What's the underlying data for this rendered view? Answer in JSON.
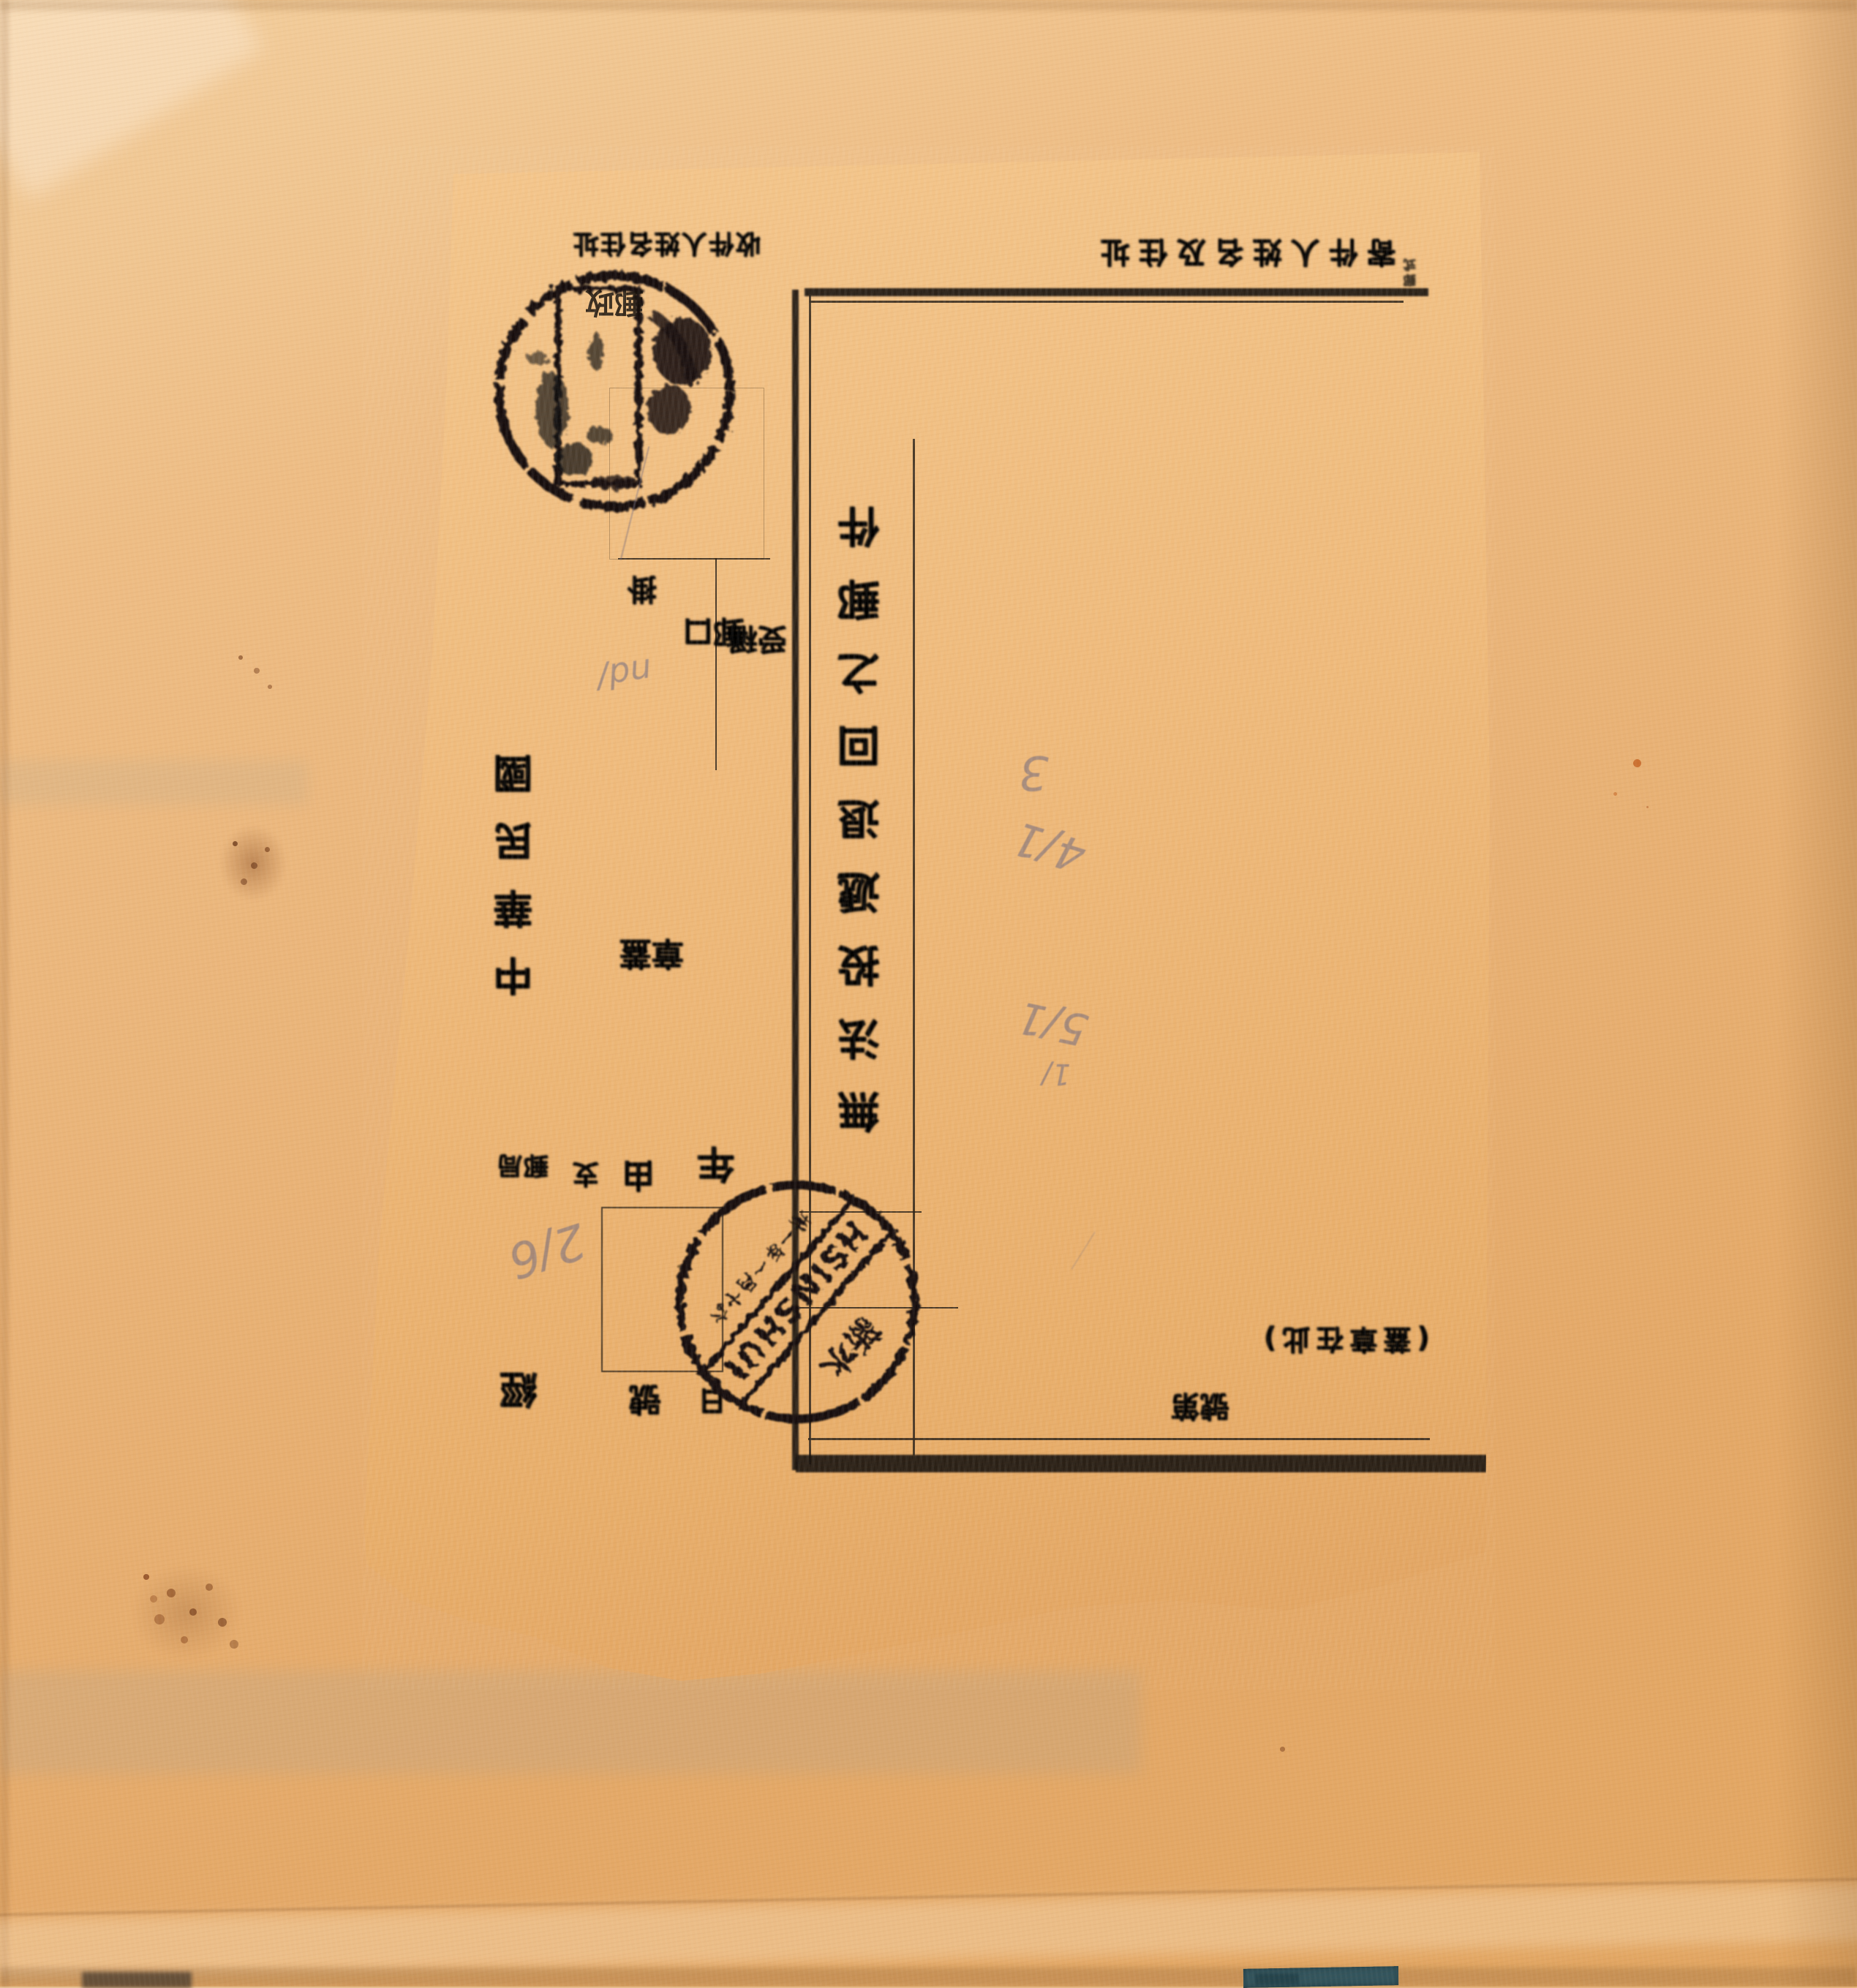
{
  "scan": {
    "description_tokens": {
      "orientation": "form pasted upside-down on album page"
    },
    "colors": {
      "album_page": "#e9b377",
      "album_highlight": "#f3cf9e",
      "form_paper": "#efba7b",
      "ink": "#1b1510",
      "pencil": "#6c667e",
      "blue_strip": "#33545c",
      "stain_brown": "#803e19"
    }
  },
  "form": {
    "title_column": "無法投遞退回之郵件",
    "recipient_label_row": "收件人姓名住址",
    "sender_label_row": "寄件人姓名及住址",
    "corner_form_mark": "郵式",
    "era_column": "中華民國",
    "seal_pair": "蓋章",
    "number_pair": "第號",
    "bracket_note": "(蓋章在此)",
    "field_lone": "掛",
    "field_col1": "口郵",
    "field_col2": "稱受",
    "glyph_bureau_pair": "郵局",
    "glyph_small": "支",
    "glyph_you": "由",
    "glyph_year": "年",
    "glyph_day": "日",
    "glyph_hao": "號",
    "glyph_jing": "經",
    "legibility_flags": {
      "title_column": "smudged",
      "recipient_label_row": "smudged",
      "sender_label_row": "smudged",
      "field_labels": "illegible"
    }
  },
  "postmarks": {
    "top": {
      "shape": "double-ring circle with inner rectangular cachet",
      "glyphs": "郵政",
      "legibility": "illegible"
    },
    "bottom": {
      "latin": "HSINSHUI",
      "chinese_place": "新水",
      "date_chars": "卅一年一月十六",
      "legibility": "partly legible"
    }
  },
  "pencil": {
    "marks": [
      "3",
      "4∕1",
      "5∕1",
      "1∕",
      "2∕6",
      "nd∕"
    ]
  }
}
